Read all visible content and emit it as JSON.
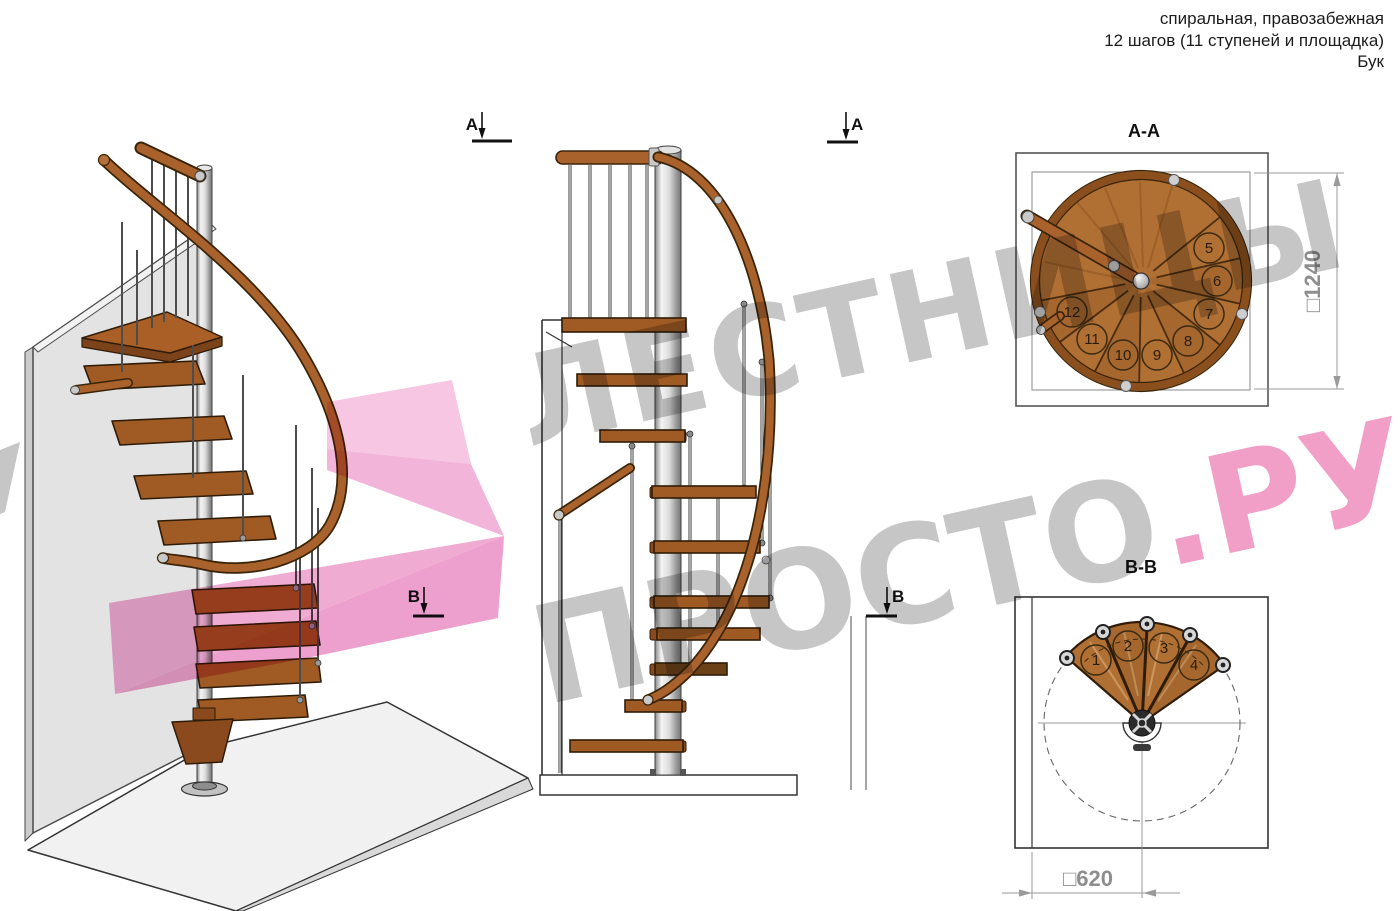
{
  "header": {
    "line1": "спиральная, правозабежная",
    "line2": "12 шагов (11 ступеней и площадка)",
    "line3": "Бук"
  },
  "watermark": {
    "line1": "ЛЕСТНИЦЫ",
    "line2_gray": "ПРОСТО",
    "line2_pink": ".РУ"
  },
  "section_aa": {
    "title": "А-А",
    "dim_label": "□1240",
    "steps": [
      "5",
      "6",
      "7",
      "8",
      "9",
      "10",
      "11",
      "12"
    ]
  },
  "section_bb": {
    "title": "В-В",
    "dim_label": "□620",
    "steps": [
      "1",
      "2",
      "3",
      "4"
    ]
  },
  "markers": {
    "a": "А",
    "b": "В"
  },
  "colors": {
    "wood": "#b06f33",
    "wood_dark": "#8a4a1d",
    "handrail": "#a9622c",
    "pole_gray": "#c9c9c9",
    "watermark_gray": "#c6c6c6",
    "watermark_pink": "#f29fc8",
    "dim_gray": "#999999"
  }
}
